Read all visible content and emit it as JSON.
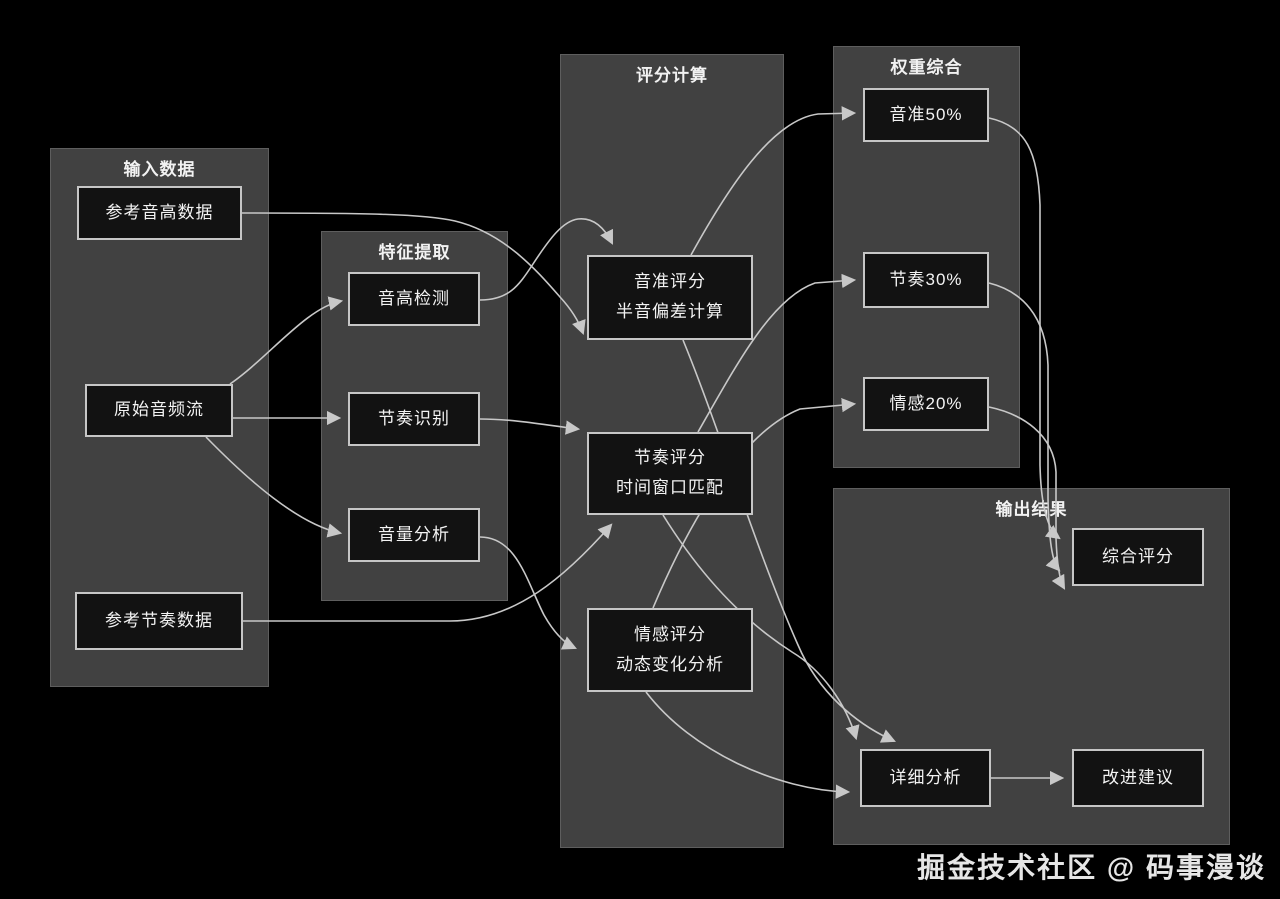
{
  "canvas": {
    "width": 1280,
    "height": 899,
    "background": "#000000"
  },
  "colors": {
    "group_fill": "#414141",
    "group_border": "#5e5e5e",
    "node_fill": "#121212",
    "node_border": "#c6c6c6",
    "edge_stroke": "#c8c8c8",
    "text": "#f3f3f3"
  },
  "watermark": {
    "text": "掘金技术社区 @ 码事漫谈"
  },
  "groups": [
    {
      "id": "input",
      "title": "输入数据",
      "x": 50,
      "y": 148,
      "w": 219,
      "h": 539
    },
    {
      "id": "feature",
      "title": "特征提取",
      "x": 321,
      "y": 231,
      "w": 187,
      "h": 370
    },
    {
      "id": "score",
      "title": "评分计算",
      "x": 560,
      "y": 54,
      "w": 224,
      "h": 794
    },
    {
      "id": "weight",
      "title": "权重综合",
      "x": 833,
      "y": 46,
      "w": 187,
      "h": 422
    },
    {
      "id": "output",
      "title": "输出结果",
      "x": 833,
      "y": 488,
      "w": 397,
      "h": 357
    }
  ],
  "nodes": [
    {
      "id": "ref_pitch",
      "lines": [
        "参考音高数据"
      ],
      "x": 77,
      "y": 186,
      "w": 165,
      "h": 54
    },
    {
      "id": "raw_audio",
      "lines": [
        "原始音频流"
      ],
      "x": 85,
      "y": 384,
      "w": 148,
      "h": 53
    },
    {
      "id": "ref_rhythm",
      "lines": [
        "参考节奏数据"
      ],
      "x": 75,
      "y": 592,
      "w": 168,
      "h": 58
    },
    {
      "id": "pitch_detect",
      "lines": [
        "音高检测"
      ],
      "x": 348,
      "y": 272,
      "w": 132,
      "h": 54
    },
    {
      "id": "rhythm_detect",
      "lines": [
        "节奏识别"
      ],
      "x": 348,
      "y": 392,
      "w": 132,
      "h": 54
    },
    {
      "id": "volume",
      "lines": [
        "音量分析"
      ],
      "x": 348,
      "y": 508,
      "w": 132,
      "h": 54
    },
    {
      "id": "pitch_score",
      "lines": [
        "音准评分",
        "半音偏差计算"
      ],
      "x": 587,
      "y": 255,
      "w": 166,
      "h": 85
    },
    {
      "id": "rhythm_score",
      "lines": [
        "节奏评分",
        "时间窗口匹配"
      ],
      "x": 587,
      "y": 432,
      "w": 166,
      "h": 83
    },
    {
      "id": "emotion_score",
      "lines": [
        "情感评分",
        "动态变化分析"
      ],
      "x": 587,
      "y": 608,
      "w": 166,
      "h": 84
    },
    {
      "id": "w_pitch",
      "lines": [
        "音准50%"
      ],
      "x": 863,
      "y": 88,
      "w": 126,
      "h": 54
    },
    {
      "id": "w_rhythm",
      "lines": [
        "节奏30%"
      ],
      "x": 863,
      "y": 252,
      "w": 126,
      "h": 56
    },
    {
      "id": "w_emotion",
      "lines": [
        "情感20%"
      ],
      "x": 863,
      "y": 377,
      "w": 126,
      "h": 54
    },
    {
      "id": "final_score",
      "lines": [
        "综合评分"
      ],
      "x": 1072,
      "y": 528,
      "w": 132,
      "h": 58
    },
    {
      "id": "detail",
      "lines": [
        "详细分析"
      ],
      "x": 860,
      "y": 749,
      "w": 131,
      "h": 58
    },
    {
      "id": "suggest",
      "lines": [
        "改进建议"
      ],
      "x": 1072,
      "y": 749,
      "w": 132,
      "h": 58
    }
  ],
  "edges": [
    {
      "from": "ref_pitch",
      "to": "pitch_score",
      "path": "M242,213 C370,213 425,214 455,221 C505,233 538,272 560,297 C572,310 579,322 583,333"
    },
    {
      "from": "pitch_detect",
      "to": "pitch_score",
      "path": "M480,300 C508,300 518,287 533,264 C550,238 563,221 578,219 C596,217 606,231 612,243"
    },
    {
      "from": "raw_audio",
      "to": "pitch_detect",
      "path": "M230,384 C268,358 306,308 341,301"
    },
    {
      "from": "raw_audio",
      "to": "rhythm_detect",
      "path": "M233,418 L339,418"
    },
    {
      "from": "raw_audio",
      "to": "volume",
      "path": "M206,437 C248,480 298,524 340,533"
    },
    {
      "from": "ref_rhythm",
      "to": "rhythm_score",
      "path": "M243,621 L450,621 C515,621 566,576 611,525"
    },
    {
      "from": "rhythm_detect",
      "to": "rhythm_score",
      "path": "M480,419 C516,419 552,426 578,429"
    },
    {
      "from": "volume",
      "to": "emotion_score",
      "path": "M480,537 C517,537 527,582 544,615 C553,631 564,643 575,648"
    },
    {
      "from": "pitch_score",
      "to": "w_pitch",
      "path": "M691,255 C728,188 772,120 818,114 L854,113"
    },
    {
      "from": "rhythm_score",
      "to": "w_rhythm",
      "path": "M698,432 C738,362 772,298 815,283 L854,280"
    },
    {
      "from": "emotion_score",
      "to": "w_emotion",
      "path": "M653,608 C690,520 742,432 800,409 L854,404"
    },
    {
      "from": "pitch_score",
      "to": "detail",
      "path": "M683,340 C718,425 758,555 798,645 C818,692 856,724 894,741"
    },
    {
      "from": "rhythm_score",
      "to": "detail",
      "path": "M663,515 C702,578 745,622 792,652 C822,670 846,704 856,738"
    },
    {
      "from": "emotion_score",
      "to": "detail",
      "path": "M646,692 C692,752 778,790 848,792"
    },
    {
      "from": "w_pitch",
      "to": "final_score",
      "path": "M989,118 C1026,126 1038,152 1040,205 L1040,465 C1041,508 1048,530 1059,538"
    },
    {
      "from": "w_rhythm",
      "to": "final_score",
      "path": "M989,283 C1021,291 1046,315 1048,365 L1048,498 C1049,540 1052,562 1059,570"
    },
    {
      "from": "w_emotion",
      "to": "final_score",
      "path": "M989,407 C1022,414 1054,434 1056,472 L1056,538 C1057,565 1060,581 1064,588"
    },
    {
      "from": "detail",
      "to": "suggest",
      "path": "M991,778 L1062,778"
    }
  ]
}
